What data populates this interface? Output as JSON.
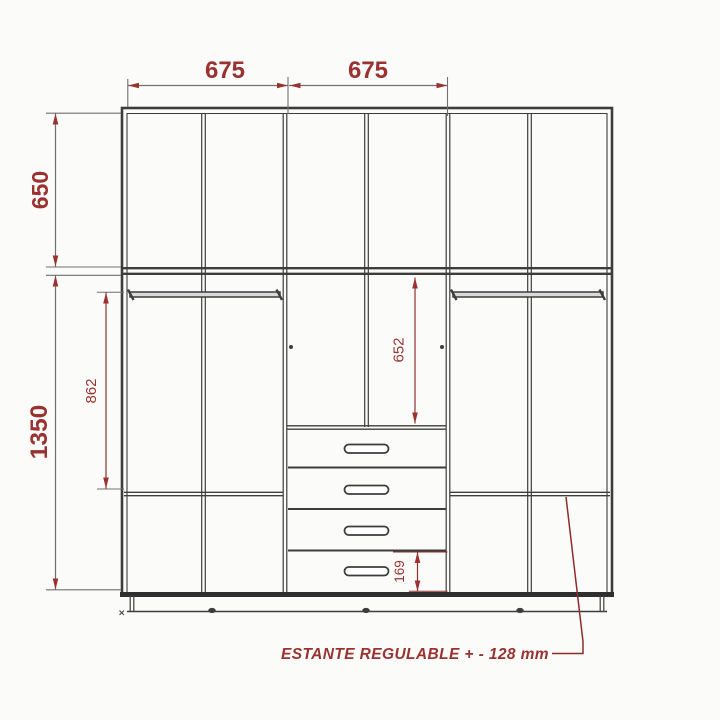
{
  "diagram": {
    "dimensions": {
      "width_left_module": "675",
      "width_center_module": "675",
      "upper_cabinet_height": "650",
      "lower_cabinet_height": "1350",
      "hanging_section_height": "862",
      "center_opening_height": "652",
      "bottom_drawer_height": "169"
    },
    "annotation": {
      "adjustable_shelf_note": "ESTANTE REGULABLE + - 128 mm"
    },
    "structure": {
      "upper_door_compartments": 6,
      "drawer_count": 4,
      "hanging_rail_count": 2,
      "adjustable_shelf_count": 2
    },
    "colors": {
      "dimension_accent": "#9a3230",
      "carcass_line": "#3d3d3d",
      "background": "#fbfbf9"
    }
  }
}
